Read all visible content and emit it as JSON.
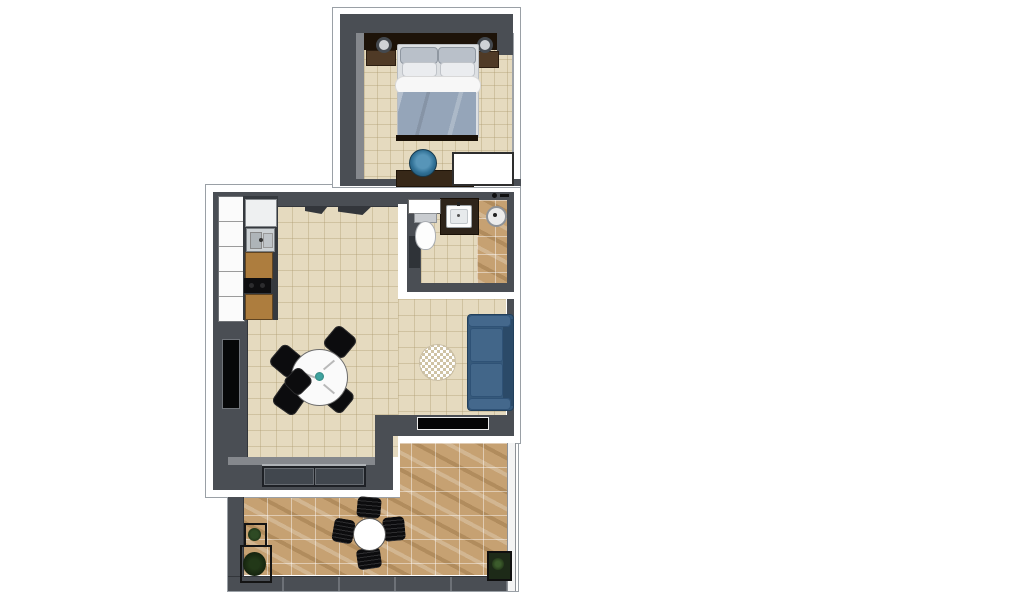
{
  "scene": {
    "type": "3d-floor-plan-top-down-view",
    "background": "#ffffff",
    "units": "apartment with bedroom, living-dining room, kitchen, bathroom and balcony"
  },
  "colors": {
    "wall": "#4a4e54",
    "wall_dark": "#33363b",
    "wall_light": "#85888d",
    "outline": "#9aa0a6",
    "floor_tile": "#e5dabf",
    "wood_floor": "#c6a172",
    "sofa": "#36597a",
    "sofa_dark": "#2b4a68",
    "sofa_light": "#44688c",
    "duvet": "#95a5b9",
    "blanket": "#f7f7f7",
    "pillow_silver": "#b9c0c9",
    "pillow_white": "#eaecef",
    "headboard": "#1d1309",
    "nightstand": "#4f3a26",
    "dresser": "#372818",
    "chair_black": "#0c0c0e",
    "table_white": "#fafafa",
    "desk_chair": "#2f6f94",
    "desk_chair_light": "#5795b8",
    "kitchen_wood": "#ad7d3e",
    "cooktop": "#0e0e10",
    "fridge": "#eef0f1",
    "sink_steel": "#ccd1d4",
    "vanity": "#2e241a",
    "porcelain": "#fdfdfd",
    "rug_check": "#cfc3a5",
    "plant": "#2e4a24",
    "plant_dark": "#15240f",
    "accent_teal": "#3fa3a0",
    "window_frame": "#1e2126",
    "window_glass": "#41474e",
    "tv": "#060708"
  },
  "rooms": [
    {
      "id": "bedroom",
      "furniture": [
        "headboard",
        "double-bed",
        "pillows-x4",
        "blanket-roll",
        "duvet",
        "nightstand-left",
        "nightstand-right",
        "table-lamp-left",
        "table-lamp-right",
        "dresser",
        "desk-chair",
        "closet"
      ]
    },
    {
      "id": "living-dining",
      "furniture": [
        "round-dining-table",
        "dining-chairs-x5",
        "table-centerpiece",
        "round-rug",
        "sofa",
        "wall-tv",
        "entry-door-openings",
        "balcony-window",
        "window-strip"
      ]
    },
    {
      "id": "kitchen",
      "furniture": [
        "upper-cabinet-row",
        "refrigerator",
        "kitchen-sink",
        "base-cabinet-1",
        "cooktop",
        "base-cabinet-2"
      ]
    },
    {
      "id": "bathroom",
      "furniture": [
        "toilet",
        "wall-shelf",
        "vanity-counter",
        "basin",
        "shower-floor",
        "shower-drain",
        "shower-fixtures",
        "door-recess"
      ]
    },
    {
      "id": "balcony",
      "furniture": [
        "outdoor-round-table",
        "outdoor-chairs-x4",
        "planter-small",
        "planter-large",
        "planter-right",
        "railing"
      ]
    }
  ]
}
